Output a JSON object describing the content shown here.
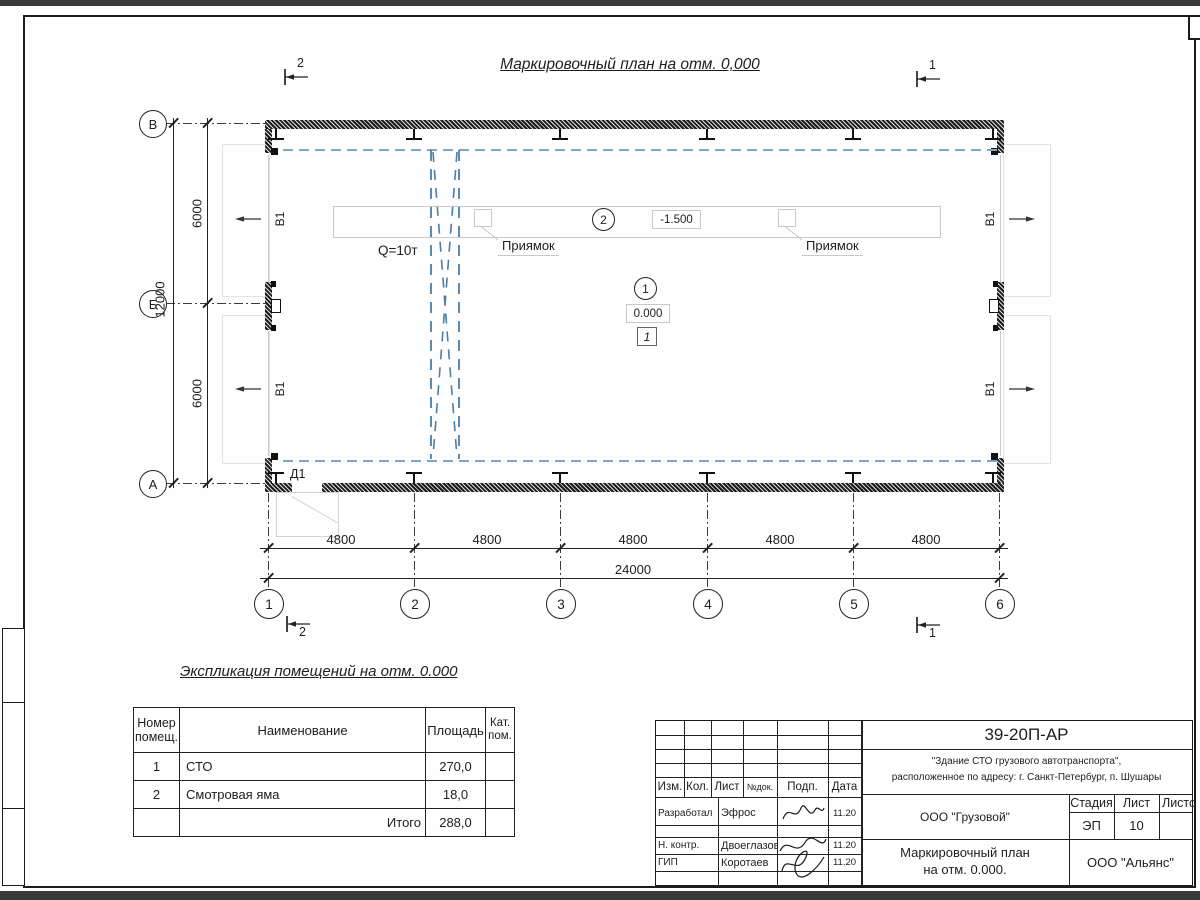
{
  "page": {
    "title": "Маркировочный план на отм. 0,000"
  },
  "plan": {
    "row_axes": [
      "В",
      "Б",
      "А"
    ],
    "col_axes": [
      "1",
      "2",
      "3",
      "4",
      "5",
      "6"
    ],
    "dim_v_total": "12000",
    "dim_v_segs": [
      "6000",
      "6000"
    ],
    "dim_h_segs": [
      "4800",
      "4800",
      "4800",
      "4800",
      "4800"
    ],
    "dim_h_total": "24000",
    "crane_label": "Q=10т",
    "pit_label": "Приямок",
    "door_label": "Д1",
    "window_label": "В1",
    "room1_num": "1",
    "room2_num": "2",
    "elev_floor": "0.000",
    "elev_pit": "-1.500",
    "floor_mark": "1",
    "section1": "1",
    "section2": "2"
  },
  "explication": {
    "title": "Экспликация помещений на отм. 0.000",
    "h_num1": "Номер",
    "h_num2": "помещ.",
    "h_name": "Наименование",
    "h_area": "Площадь",
    "h_cat1": "Кат.",
    "h_cat2": "пом.",
    "rows": [
      {
        "num": "1",
        "name": "СТО",
        "area": "270,0"
      },
      {
        "num": "2",
        "name": "Смотровая яма",
        "area": "18,0"
      }
    ],
    "total_label": "Итого",
    "total_area": "288,0"
  },
  "titleblock": {
    "code": "39-20П-АР",
    "object_line1": "\"Здание СТО грузового автотранспорта\",",
    "object_line2": "расположенное по адресу: г. Санкт-Петербург, п. Шушары",
    "client": "ООО \"Грузовой\"",
    "stage_label": "Стадия",
    "sheet_label": "Лист",
    "sheets_label": "Листов",
    "stage": "ЭП",
    "sheet": "10",
    "sheets": "",
    "doc_line1": "Маркировочный план",
    "doc_line2": "на отм. 0.000.",
    "org": "ООО \"Альянс\"",
    "cols": [
      "Изм.",
      "Кол.",
      "Лист",
      "№док.",
      "Подп.",
      "Дата"
    ],
    "roles": [
      {
        "role": "Разработал",
        "name": "Эфрос",
        "date": "11.20"
      },
      {
        "role": "Н. контр.",
        "name": "Двоеглазов",
        "date": "11.20"
      },
      {
        "role": "ГИП",
        "name": "Коротаев",
        "date": "11.20"
      }
    ]
  },
  "colors": {
    "line": "#1e1e1e",
    "light": "#c9c9c9",
    "blue_runway": "#7fa6c3",
    "blue_crane": "#4b7da6"
  }
}
